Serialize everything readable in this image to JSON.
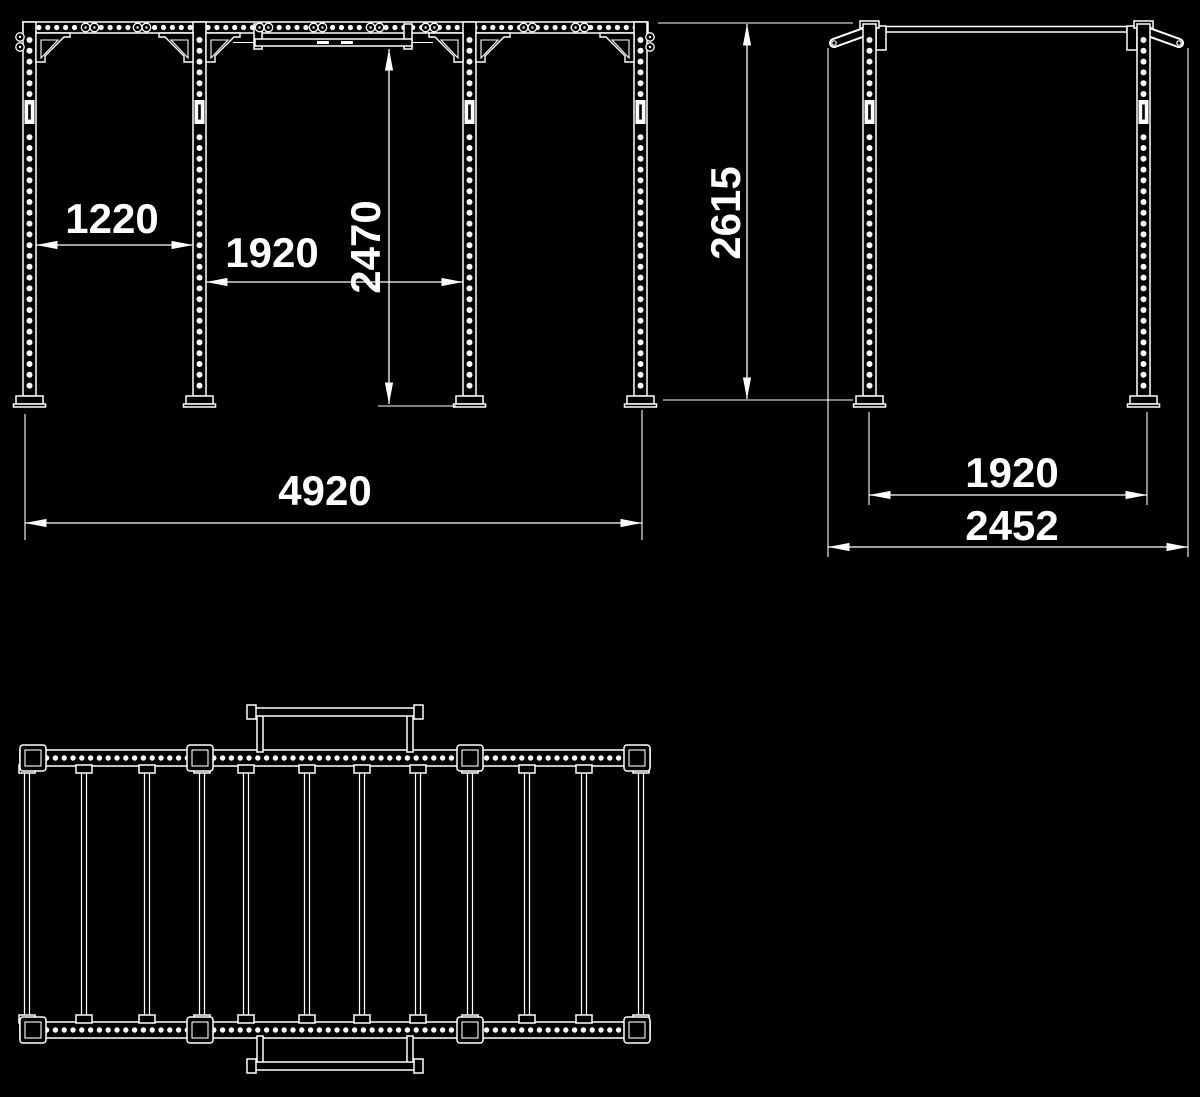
{
  "colors": {
    "background": "#000000",
    "ink": "#ffffff"
  },
  "views": {
    "front": {
      "dim_bay_left": "1220",
      "dim_bay_center": "1920",
      "dim_bar_height": "2470",
      "dim_overall_width": "4920"
    },
    "side": {
      "dim_height": "2615",
      "dim_depth_inner": "1920",
      "dim_depth_overall": "2452"
    }
  }
}
